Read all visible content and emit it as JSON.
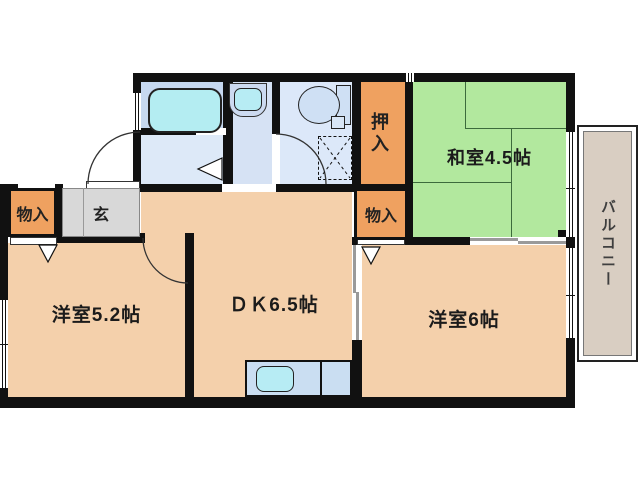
{
  "plan": {
    "rooms": {
      "washitsu": {
        "label": "和室4.5帖"
      },
      "dk": {
        "label": "ＤＫ6.5帖"
      },
      "bedroom_left": {
        "label": "洋室5.2帖"
      },
      "bedroom_right": {
        "label": "洋室6帖"
      },
      "genkan": {
        "label": "玄"
      },
      "oshiire": {
        "label": "押入"
      },
      "storage_left": {
        "label": "物入"
      },
      "storage_right": {
        "label": "物入"
      },
      "balcony": {
        "label": "バルコニー"
      }
    },
    "fixtures": [
      "bathtub",
      "washbasin",
      "toilet",
      "kitchen-sink",
      "washing-machine-space"
    ],
    "colors": {
      "wall": "#111111",
      "tatami_room": "#b2e89e",
      "western_room": "#f4d0ab",
      "storage": "#efa160",
      "genkan_floor": "#d8d8d8",
      "balcony_floor": "#d9cec2",
      "bath_room": "#c6d8f0",
      "bathtub": "#b4edf2",
      "washroom": "#dde9f8",
      "washbasin_room": "#d6e2f4",
      "toilet_room": "#dce8f9",
      "kitchen_counter": "#cadef2",
      "kitchen_sink": "#b7ecf4"
    }
  }
}
